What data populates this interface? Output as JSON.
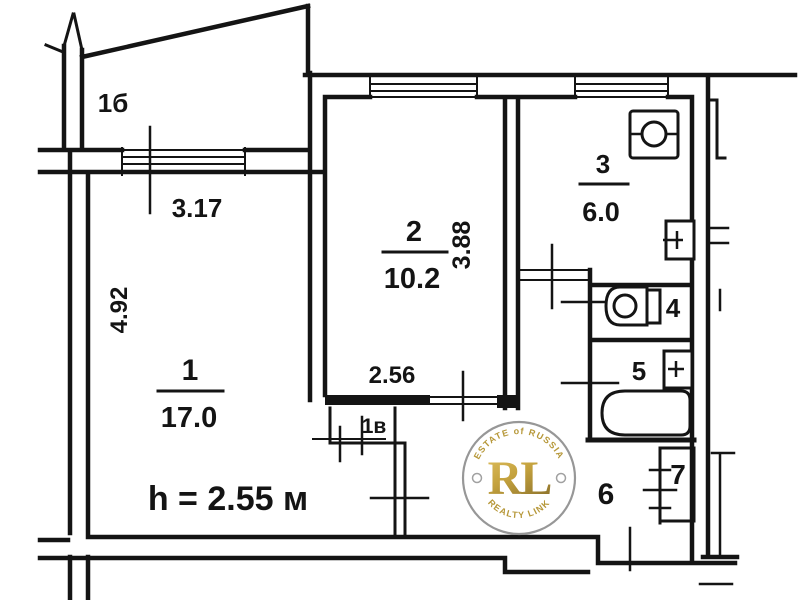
{
  "plan": {
    "ceiling_height_note": "h = 2.55 м",
    "balcony": {
      "number": "1б"
    },
    "rooms": {
      "living": {
        "number": "1",
        "area": "17.0"
      },
      "bedroom": {
        "number": "2",
        "area": "10.2"
      },
      "kitchen": {
        "number": "3",
        "area": "6.0"
      },
      "wc": {
        "number": "4"
      },
      "bathroom": {
        "number": "5"
      },
      "hallway": {
        "number": "6"
      },
      "closet": {
        "number": "7"
      },
      "wardrobe": {
        "number": "1в"
      }
    },
    "dimensions": {
      "balcony_width": "3.17",
      "living_depth": "4.92",
      "bedroom_width": "2.56",
      "bedroom_depth": "3.88"
    }
  },
  "watermark": {
    "arc_top": "ESTATE of RUSSIA",
    "monogram": "RL",
    "arc_bottom": "REALTY LINK",
    "gold_color": "#b08f28",
    "ring_color": "#8f8f8f"
  },
  "colors": {
    "ink": "#141414",
    "background": "#ffffff"
  }
}
